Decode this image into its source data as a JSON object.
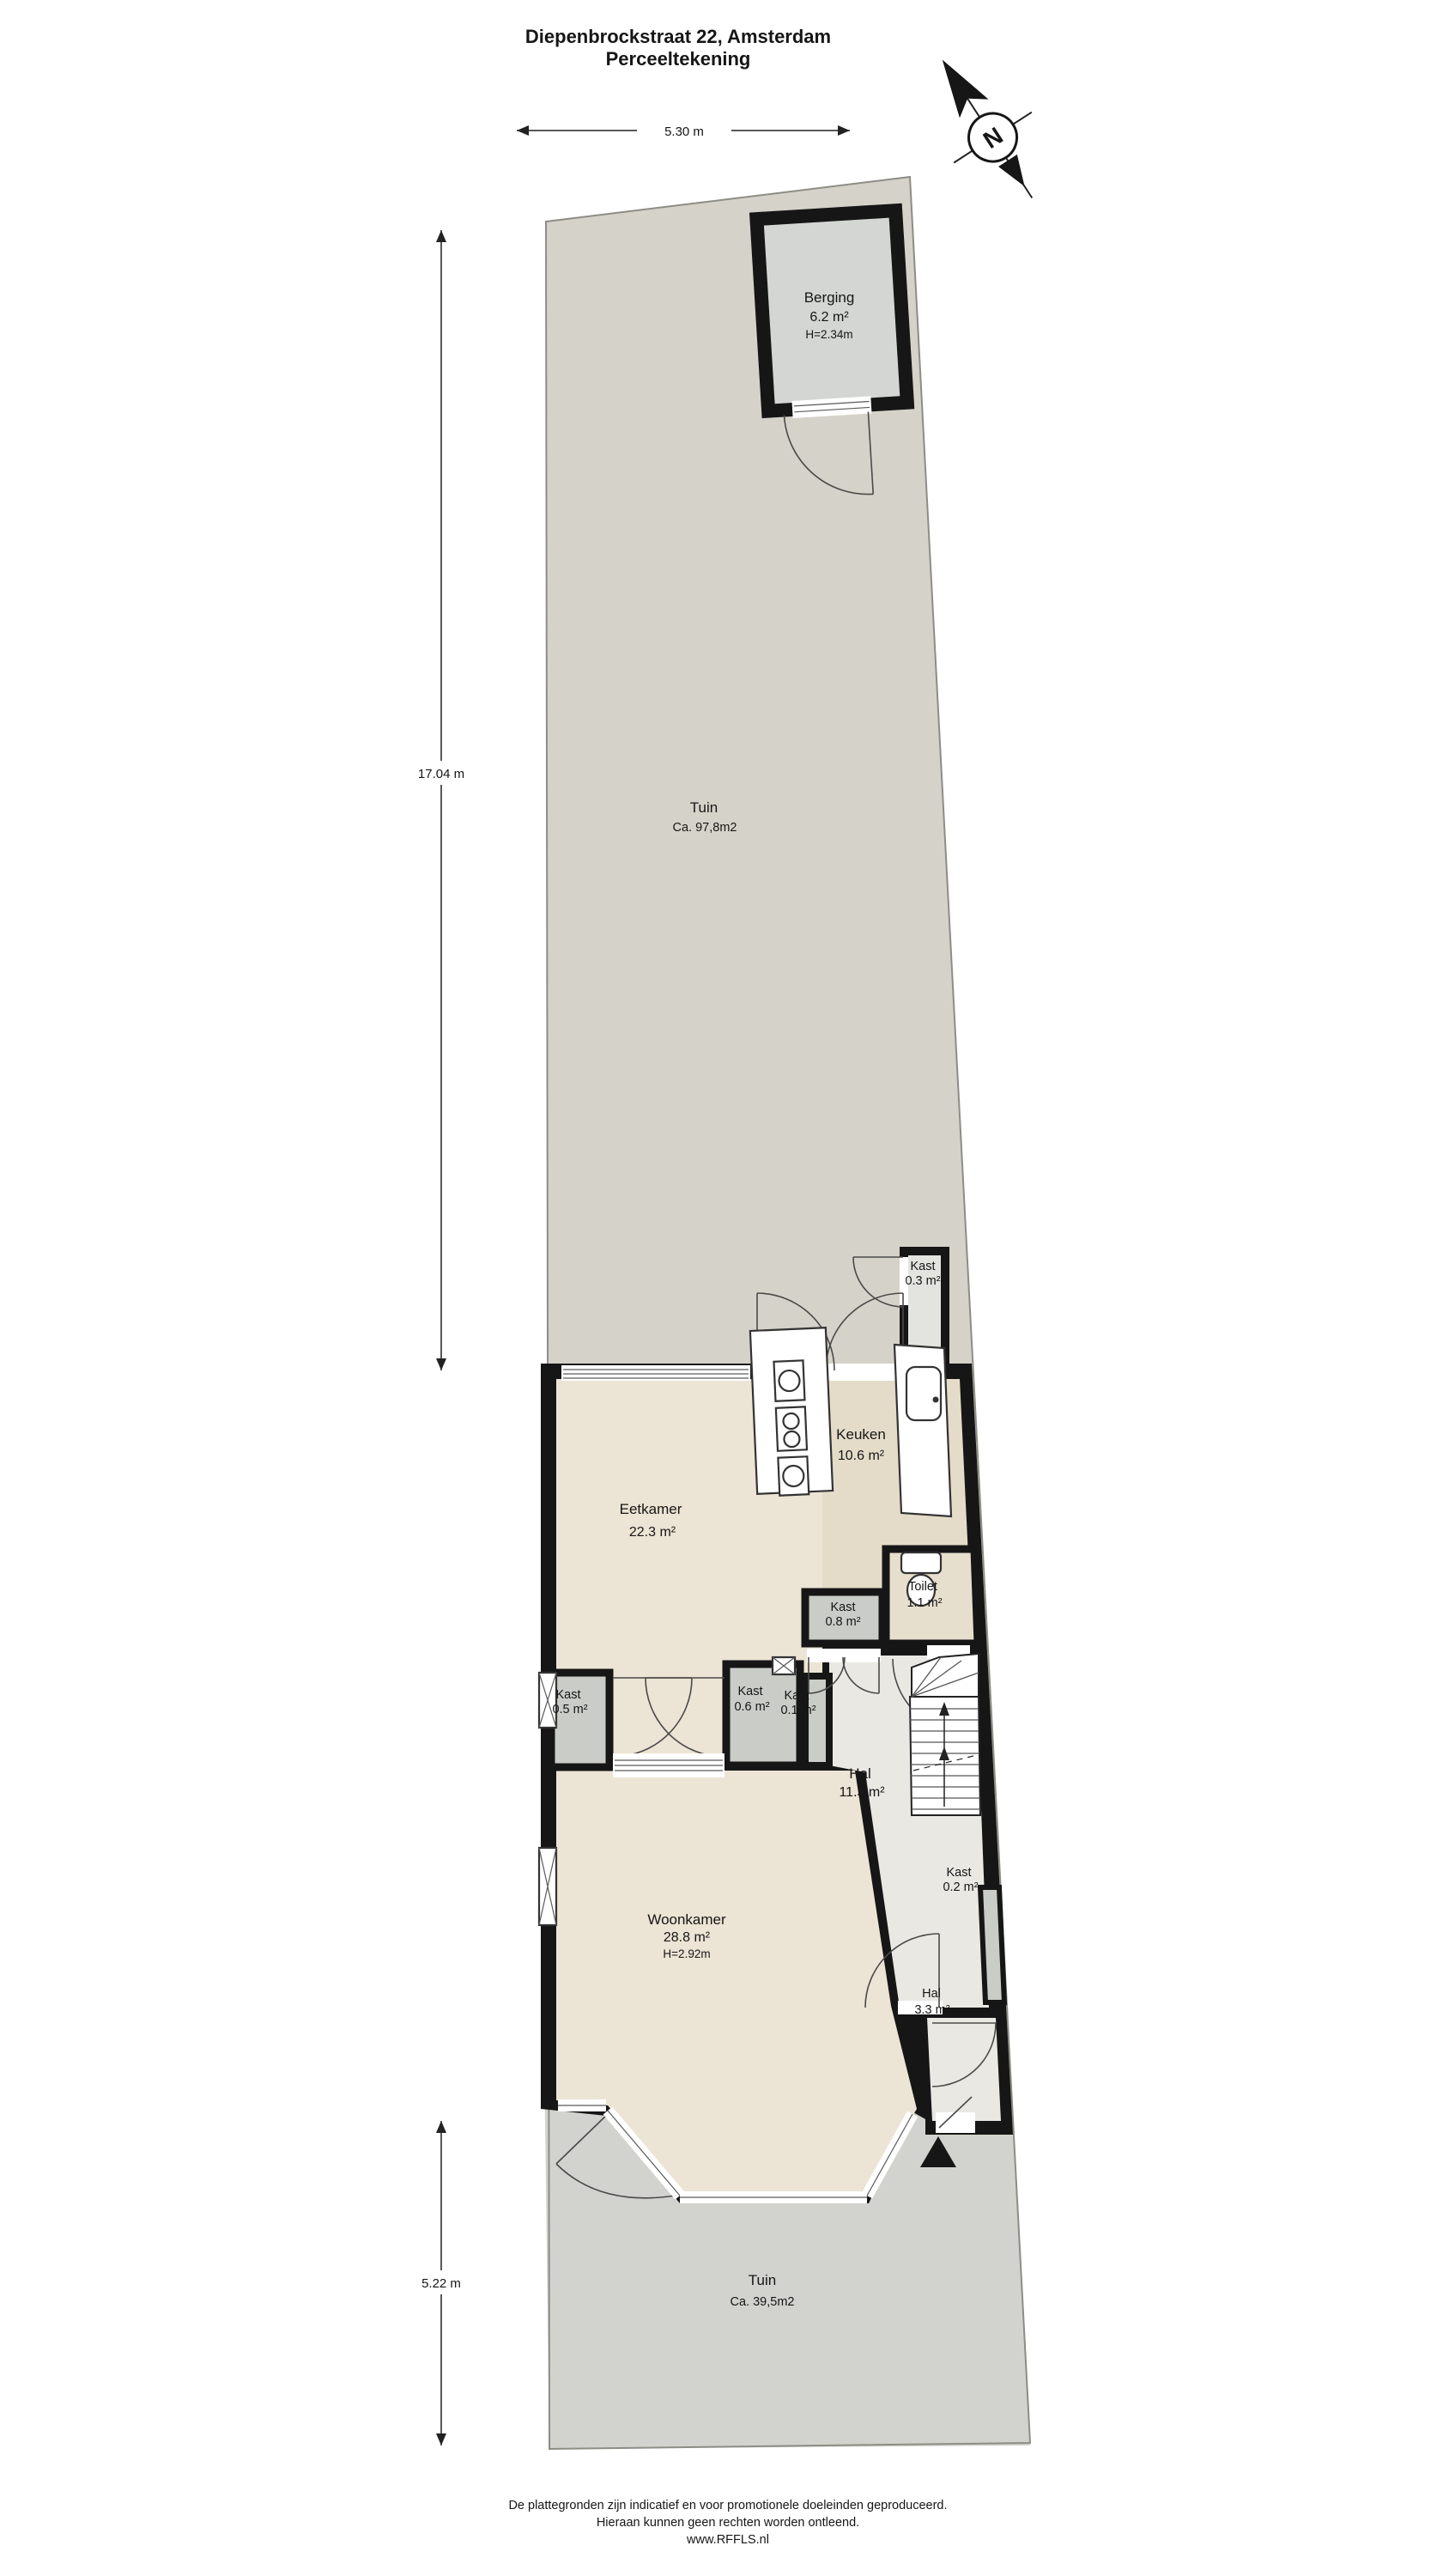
{
  "title": {
    "line1": "Diepenbrockstraat 22, Amsterdam",
    "line2": "Perceeltekening"
  },
  "compass": {
    "label": "N"
  },
  "dimensions": {
    "top": "5.30 m",
    "left_upper": "17.04 m",
    "left_lower": "5.22 m"
  },
  "rooms": {
    "berging": {
      "name": "Berging",
      "area": "6.2 m²",
      "height": "H=2.34m"
    },
    "tuin_achter": {
      "name": "Tuin",
      "area": "Ca. 97,8m2"
    },
    "kast_03": {
      "name": "Kast",
      "area": "0.3 m²"
    },
    "eetkamer": {
      "name": "Eetkamer",
      "area": "22.3 m²"
    },
    "keuken": {
      "name": "Keuken",
      "area": "10.6 m²"
    },
    "toilet": {
      "name": "Toilet",
      "area": "1.1 m²"
    },
    "kast_08": {
      "name": "Kast",
      "area": "0.8 m²"
    },
    "kast_05": {
      "name": "Kast",
      "area": "0.5 m²"
    },
    "kast_06": {
      "name": "Kast",
      "area": "0.6 m²"
    },
    "kast_01": {
      "name": "Kast",
      "area": "0.1 m²"
    },
    "hal_11": {
      "name": "Hal",
      "area": "11.3 m²"
    },
    "kast_02": {
      "name": "Kast",
      "area": "0.2 m²"
    },
    "woonkamer": {
      "name": "Woonkamer",
      "area": "28.8 m²",
      "height": "H=2.92m"
    },
    "hal_33": {
      "name": "Hal",
      "area": "3.3 m²"
    },
    "tuin_voor": {
      "name": "Tuin",
      "area": "Ca. 39,5m2"
    }
  },
  "footer": {
    "line1": "De plattegronden zijn indicatief en voor promotionele doeleinden geproduceerd.",
    "line2": "Hieraan kunnen geen rechten worden ontleend.",
    "line3": "www.RFFLS.nl"
  },
  "colors": {
    "wall": "#161616",
    "garden_back": "#d5d2c9",
    "garden_front": "#d2d3ce",
    "berging_floor": "#d3d6d2",
    "floor_living": "#ece4d4",
    "floor_kitchen": "#e4dcc9",
    "floor_toilet": "#e7dfcd",
    "floor_hall": "#e9e8e3",
    "closet_fill": "#c9ccc7"
  }
}
